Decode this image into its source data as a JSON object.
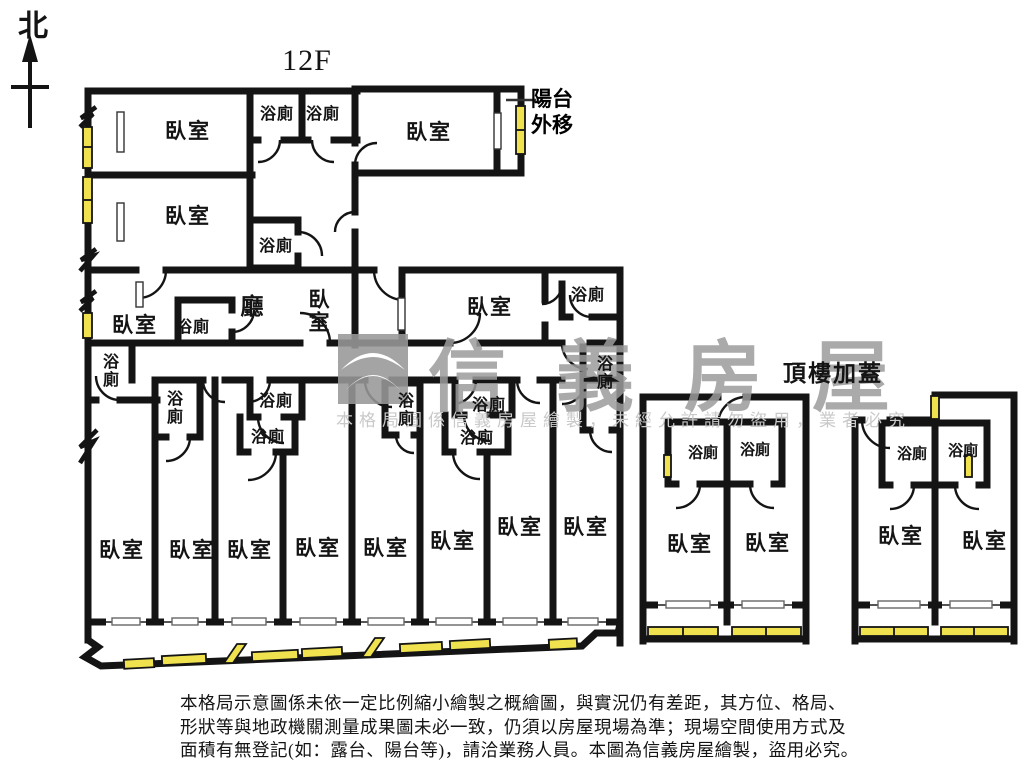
{
  "page": {
    "floor_title": "12F",
    "compass": "北"
  },
  "annotations": {
    "balcony_moved": "陽台\n外移",
    "rooftop_addition": "頂樓加蓋"
  },
  "room_labels": {
    "bedroom": "臥室",
    "bathroom": "浴廁",
    "living_room": "廳"
  },
  "watermark": {
    "brand": "信義房屋",
    "notice": "本格局圖係信義房屋繪製，未經允許請勿盜用，業者必究"
  },
  "disclaimer": {
    "line1": "本格局示意圖係未依一定比例縮小繪製之概繪圖，與實況仍有差距，其方位、格局、",
    "line2": "形狀等與地政機關測量成果圖未必一致，仍須以房屋現場為準；現場空間使用方式及",
    "line3": "面積有無登記(如：露台、陽台等)，請洽業務人員。本圖為信義房屋繪製，盜用必究。"
  },
  "colors": {
    "wall": "#141414",
    "window_yellow": "#efe24e",
    "watermark_gray": "#9c9c9c",
    "watermark_light": "#c9c9c9"
  }
}
